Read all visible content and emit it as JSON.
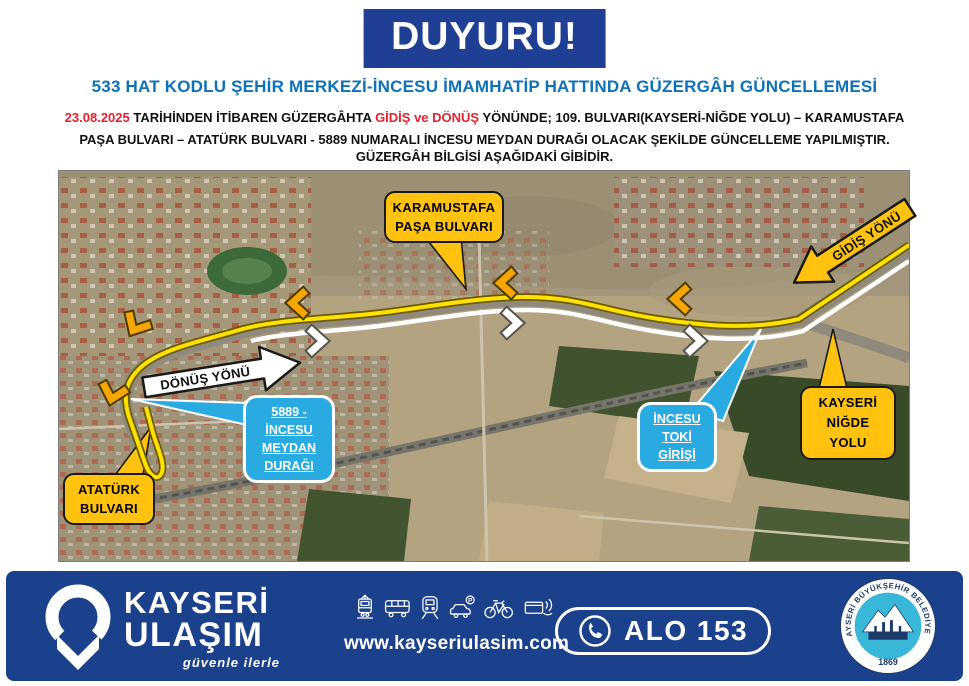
{
  "banner": {
    "text": "DUYURU!"
  },
  "heading": "533 HAT KODLU ŞEHİR MERKEZİ-İNCESU İMAMHATİP HATTINDA GÜZERGÂH GÜNCELLEMESİ",
  "body": {
    "date": "23.08.2025",
    "seg1": " TARİHİNDEN İTİBAREN GÜZERGÂHTA ",
    "gidis": "GİDİŞ",
    "ve": " ve ",
    "donus": "DÖNÜŞ",
    "seg2": " YÖNÜNDE; 109. BULVARI(KAYSERİ-NİĞDE YOLU) – KARAMUSTAFA PAŞA BULVARI –  ATATÜRK BULVARI - 5889 NUMARALI İNCESU MEYDAN DURAĞI OLACAK ŞEKİLDE GÜNCELLEME YAPILMIŞTIR.",
    "line2": "GÜZERGÂH BİLGİSİ AŞAĞIDAKİ GİBİDİR."
  },
  "map": {
    "labels": {
      "karamustafa": [
        "KARAMUSTAFA",
        "PAŞA BULVARI"
      ],
      "gidis_yonu": "GİDİŞ YÖNÜ",
      "donus_yonu": "DÖNÜŞ YÖNÜ",
      "meydan": [
        "5889 -",
        "İNCESU",
        "MEYDAN",
        "DURAĞI"
      ],
      "toki": [
        "İNCESU",
        "TOKİ",
        "GİRİŞİ"
      ],
      "nigde": [
        "KAYSERİ",
        "NİĞDE",
        "YOLU"
      ],
      "ataturk": [
        "ATATÜRK",
        "BULVARI"
      ]
    }
  },
  "footer": {
    "brand_line1": "KAYSERİ",
    "brand_line2": "ULAŞIM",
    "tagline": "güvenle ilerle",
    "website": "www.kayseriulasim.com",
    "phone": "ALO 153",
    "badge_title": "KAYSERİ BÜYÜKŞEHİR BELEDİYESİ",
    "badge_year": "1869",
    "parking_letter": "P",
    "icons": [
      "tram",
      "bus",
      "metro",
      "car-parking",
      "bicycle",
      "card-payment"
    ]
  },
  "colors": {
    "banner_blue": "#1e3f94",
    "title_blue": "#0d72b9",
    "alert_red": "#e8222d",
    "footer_blue": "#1c418c",
    "label_yellow": "#ffc20e",
    "label_blue": "#29abe2",
    "route_yellow": "#ffe100"
  }
}
